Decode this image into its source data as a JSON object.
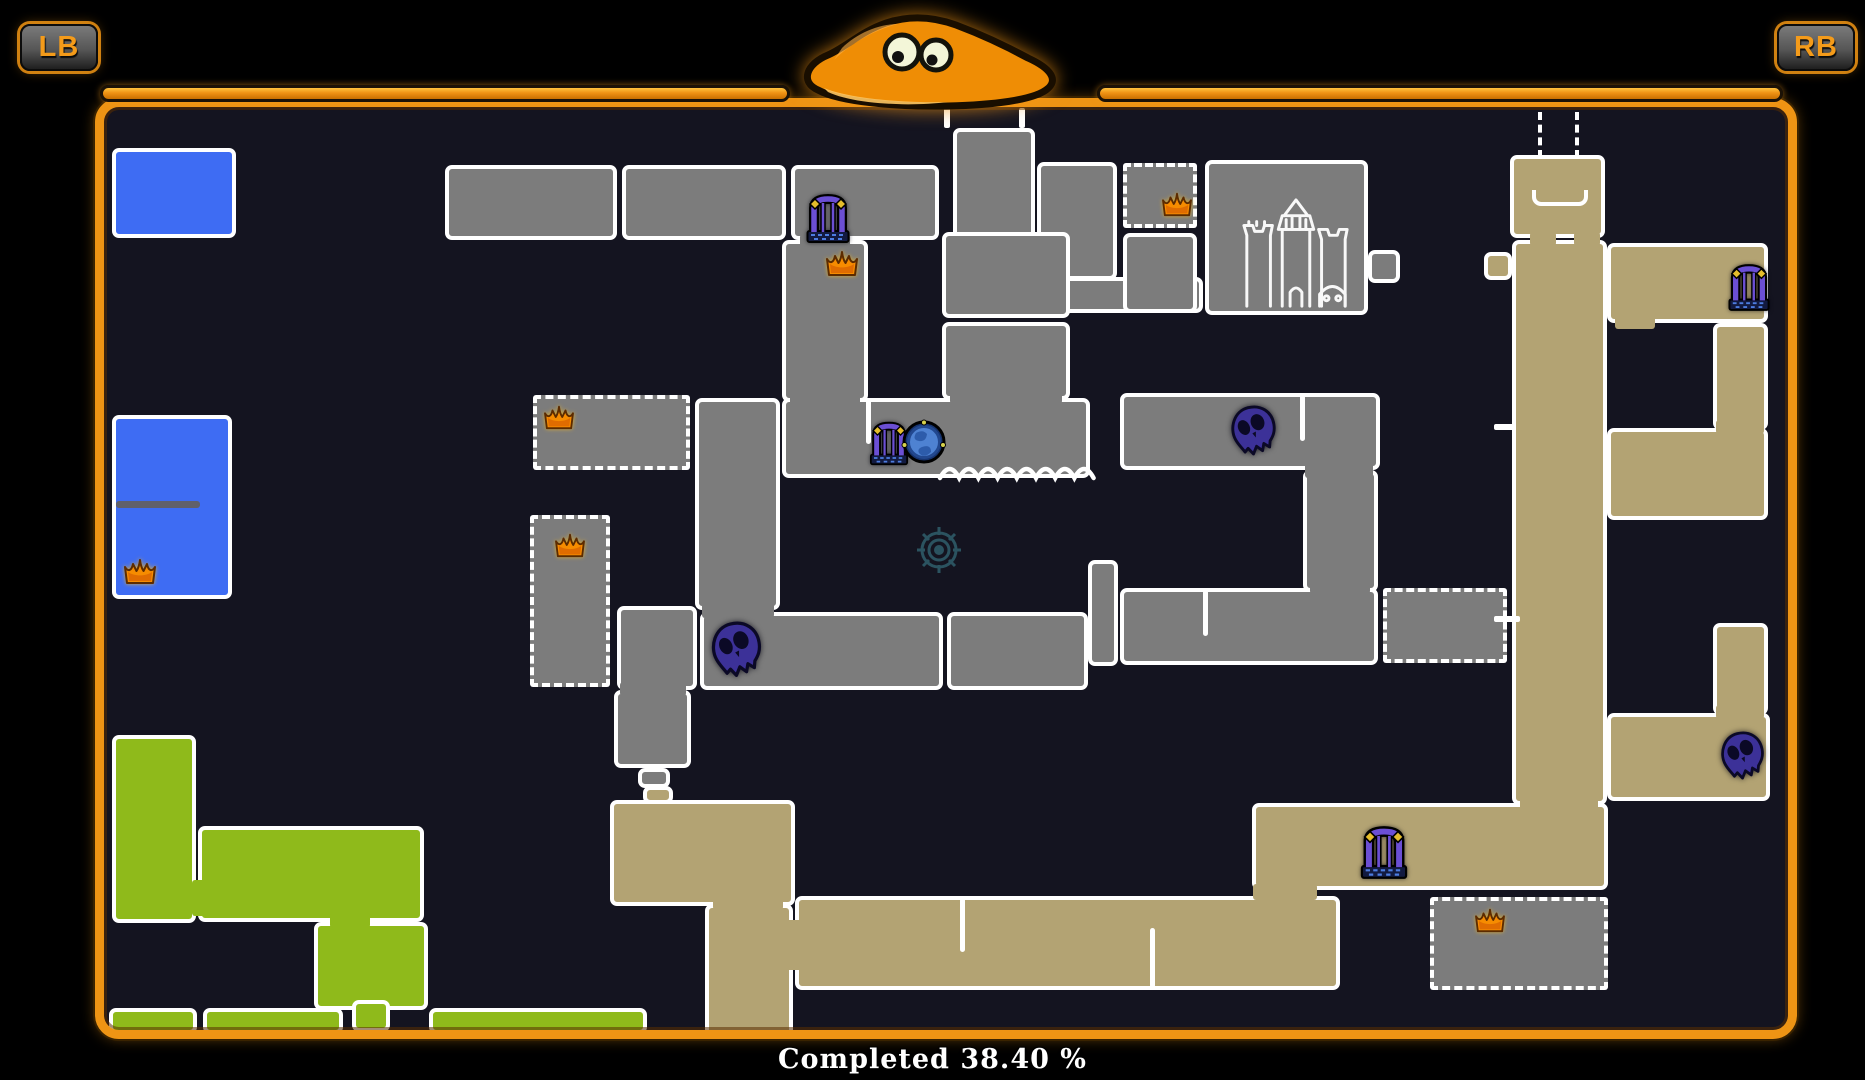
{
  "hud": {
    "left_bumper": "LB",
    "right_bumper": "RB",
    "completion_text": "Completed 38.40 %"
  },
  "colors": {
    "orange": "#ee9414",
    "mapbg": "#141420",
    "gray": "#7c7c7c",
    "tan": "#b3a373",
    "blue": "#3e6cf3",
    "green": "#8fba1b",
    "wall": "#ffffff",
    "crown": "#f68c00",
    "skull": "#3c3198",
    "gate": "#6b4fd4",
    "orb": "#4e82d2",
    "target": "#2e5a68"
  },
  "map": {
    "rooms": [
      {
        "x": 112,
        "y": 148,
        "w": 124,
        "h": 90,
        "c": "blue"
      },
      {
        "x": 112,
        "y": 415,
        "w": 120,
        "h": 184,
        "c": "blue"
      },
      {
        "x": 112,
        "y": 735,
        "w": 84,
        "h": 188,
        "c": "green"
      },
      {
        "x": 198,
        "y": 826,
        "w": 226,
        "h": 96,
        "c": "green"
      },
      {
        "x": 314,
        "y": 922,
        "w": 114,
        "h": 88,
        "c": "green"
      },
      {
        "x": 352,
        "y": 1000,
        "w": 38,
        "h": 32,
        "c": "green"
      },
      {
        "x": 109,
        "y": 1008,
        "w": 88,
        "h": 26,
        "c": "green"
      },
      {
        "x": 203,
        "y": 1008,
        "w": 140,
        "h": 26,
        "c": "green"
      },
      {
        "x": 429,
        "y": 1008,
        "w": 218,
        "h": 26,
        "c": "green"
      },
      {
        "x": 445,
        "y": 165,
        "w": 172,
        "h": 75,
        "c": "gray"
      },
      {
        "x": 622,
        "y": 165,
        "w": 164,
        "h": 75,
        "c": "gray"
      },
      {
        "x": 791,
        "y": 165,
        "w": 148,
        "h": 75,
        "c": "gray"
      },
      {
        "x": 953,
        "y": 128,
        "w": 82,
        "h": 112,
        "c": "gray"
      },
      {
        "x": 1037,
        "y": 162,
        "w": 80,
        "h": 118,
        "c": "gray"
      },
      {
        "x": 1037,
        "y": 277,
        "w": 166,
        "h": 36,
        "c": "gray"
      },
      {
        "x": 1123,
        "y": 163,
        "w": 74,
        "h": 65,
        "c": "gray",
        "b": "dashed"
      },
      {
        "x": 1123,
        "y": 233,
        "w": 74,
        "h": 80,
        "c": "gray"
      },
      {
        "x": 1205,
        "y": 160,
        "w": 163,
        "h": 155,
        "c": "gray"
      },
      {
        "x": 1368,
        "y": 250,
        "w": 32,
        "h": 33,
        "c": "gray"
      },
      {
        "x": 782,
        "y": 240,
        "w": 86,
        "h": 162,
        "c": "gray"
      },
      {
        "x": 942,
        "y": 232,
        "w": 128,
        "h": 86,
        "c": "gray"
      },
      {
        "x": 942,
        "y": 322,
        "w": 128,
        "h": 78,
        "c": "gray"
      },
      {
        "x": 782,
        "y": 398,
        "w": 308,
        "h": 80,
        "c": "gray"
      },
      {
        "x": 695,
        "y": 398,
        "w": 85,
        "h": 212,
        "c": "gray"
      },
      {
        "x": 533,
        "y": 395,
        "w": 157,
        "h": 75,
        "c": "gray",
        "b": "dashed"
      },
      {
        "x": 530,
        "y": 515,
        "w": 80,
        "h": 172,
        "c": "gray",
        "b": "dashed"
      },
      {
        "x": 617,
        "y": 606,
        "w": 80,
        "h": 84,
        "c": "gray"
      },
      {
        "x": 700,
        "y": 612,
        "w": 243,
        "h": 78,
        "c": "gray"
      },
      {
        "x": 947,
        "y": 612,
        "w": 141,
        "h": 78,
        "c": "gray"
      },
      {
        "x": 1088,
        "y": 560,
        "w": 30,
        "h": 106,
        "c": "gray"
      },
      {
        "x": 614,
        "y": 690,
        "w": 77,
        "h": 78,
        "c": "gray"
      },
      {
        "x": 638,
        "y": 768,
        "w": 32,
        "h": 20,
        "c": "gray"
      },
      {
        "x": 1120,
        "y": 393,
        "w": 260,
        "h": 77,
        "c": "gray"
      },
      {
        "x": 1303,
        "y": 470,
        "w": 75,
        "h": 122,
        "c": "gray"
      },
      {
        "x": 1120,
        "y": 588,
        "w": 258,
        "h": 77,
        "c": "gray"
      },
      {
        "x": 1383,
        "y": 588,
        "w": 124,
        "h": 75,
        "c": "gray",
        "b": "dashed"
      },
      {
        "x": 1430,
        "y": 897,
        "w": 178,
        "h": 93,
        "c": "gray",
        "b": "dashed"
      },
      {
        "x": 643,
        "y": 786,
        "w": 30,
        "h": 18,
        "c": "tan"
      },
      {
        "x": 610,
        "y": 800,
        "w": 185,
        "h": 106,
        "c": "tan"
      },
      {
        "x": 705,
        "y": 904,
        "w": 88,
        "h": 134,
        "c": "tan"
      },
      {
        "x": 795,
        "y": 896,
        "w": 545,
        "h": 94,
        "c": "tan"
      },
      {
        "x": 1252,
        "y": 803,
        "w": 356,
        "h": 87,
        "c": "tan"
      },
      {
        "x": 1510,
        "y": 155,
        "w": 95,
        "h": 83,
        "c": "tan"
      },
      {
        "x": 1512,
        "y": 240,
        "w": 95,
        "h": 565,
        "c": "tan"
      },
      {
        "x": 1484,
        "y": 252,
        "w": 28,
        "h": 28,
        "c": "tan"
      },
      {
        "x": 1607,
        "y": 243,
        "w": 161,
        "h": 80,
        "c": "tan"
      },
      {
        "x": 1713,
        "y": 323,
        "w": 55,
        "h": 107,
        "c": "tan"
      },
      {
        "x": 1607,
        "y": 428,
        "w": 161,
        "h": 92,
        "c": "tan"
      },
      {
        "x": 1713,
        "y": 623,
        "w": 55,
        "h": 92,
        "c": "tan"
      },
      {
        "x": 1607,
        "y": 713,
        "w": 163,
        "h": 88,
        "c": "tan"
      },
      {
        "x": 790,
        "y": 392,
        "w": 70,
        "h": 14,
        "c": "gray",
        "b": "none"
      },
      {
        "x": 950,
        "y": 390,
        "w": 112,
        "h": 14,
        "c": "gray",
        "b": "none"
      },
      {
        "x": 800,
        "y": 234,
        "w": 50,
        "h": 14,
        "c": "gray",
        "b": "none"
      },
      {
        "x": 702,
        "y": 602,
        "w": 72,
        "h": 16,
        "c": "gray",
        "b": "none"
      },
      {
        "x": 620,
        "y": 682,
        "w": 66,
        "h": 14,
        "c": "gray",
        "b": "none"
      },
      {
        "x": 1305,
        "y": 462,
        "w": 68,
        "h": 16,
        "c": "gray",
        "b": "none"
      },
      {
        "x": 1310,
        "y": 580,
        "w": 60,
        "h": 14,
        "c": "gray",
        "b": "none"
      },
      {
        "x": 713,
        "y": 898,
        "w": 70,
        "h": 12,
        "c": "tan",
        "b": "none"
      },
      {
        "x": 780,
        "y": 920,
        "w": 24,
        "h": 50,
        "c": "tan",
        "b": "none"
      },
      {
        "x": 1520,
        "y": 798,
        "w": 78,
        "h": 12,
        "c": "tan",
        "b": "none"
      },
      {
        "x": 1253,
        "y": 884,
        "w": 64,
        "h": 16,
        "c": "tan",
        "b": "none"
      },
      {
        "x": 1615,
        "y": 315,
        "w": 40,
        "h": 14,
        "c": "tan",
        "b": "none"
      },
      {
        "x": 1716,
        "y": 420,
        "w": 48,
        "h": 14,
        "c": "tan",
        "b": "none"
      },
      {
        "x": 1716,
        "y": 705,
        "w": 48,
        "h": 14,
        "c": "tan",
        "b": "none"
      },
      {
        "x": 1530,
        "y": 232,
        "w": 26,
        "h": 14,
        "c": "tan",
        "b": "none"
      },
      {
        "x": 1574,
        "y": 232,
        "w": 26,
        "h": 14,
        "c": "tan",
        "b": "none"
      },
      {
        "x": 192,
        "y": 880,
        "w": 16,
        "h": 36,
        "c": "green",
        "b": "none"
      },
      {
        "x": 330,
        "y": 912,
        "w": 40,
        "h": 16,
        "c": "green",
        "b": "none"
      },
      {
        "x": 116,
        "y": 501,
        "w": 84,
        "h": 7,
        "c": "divider",
        "b": "none"
      }
    ],
    "icons": [
      {
        "t": "crown",
        "x": 122,
        "y": 556,
        "w": 36,
        "h": 30
      },
      {
        "t": "crown",
        "x": 824,
        "y": 248,
        "w": 36,
        "h": 30
      },
      {
        "t": "crown",
        "x": 541,
        "y": 403,
        "w": 36,
        "h": 28
      },
      {
        "t": "crown",
        "x": 553,
        "y": 531,
        "w": 34,
        "h": 28
      },
      {
        "t": "crown",
        "x": 1160,
        "y": 190,
        "w": 34,
        "h": 28
      },
      {
        "t": "crown",
        "x": 1473,
        "y": 906,
        "w": 34,
        "h": 28
      },
      {
        "t": "skull",
        "x": 708,
        "y": 620,
        "w": 58,
        "h": 62
      },
      {
        "t": "skull",
        "x": 1228,
        "y": 404,
        "w": 52,
        "h": 56
      },
      {
        "t": "skull",
        "x": 1718,
        "y": 730,
        "w": 50,
        "h": 54
      },
      {
        "t": "gate",
        "x": 806,
        "y": 192,
        "w": 44,
        "h": 52
      },
      {
        "t": "gate",
        "x": 869,
        "y": 420,
        "w": 40,
        "h": 46
      },
      {
        "t": "gate",
        "x": 1360,
        "y": 824,
        "w": 48,
        "h": 56
      },
      {
        "t": "gate",
        "x": 1728,
        "y": 261,
        "w": 42,
        "h": 52
      },
      {
        "t": "orb",
        "x": 901,
        "y": 418,
        "w": 46,
        "h": 48
      },
      {
        "t": "castle",
        "x": 1236,
        "y": 196,
        "w": 120,
        "h": 118
      },
      {
        "t": "target",
        "x": 914,
        "y": 524,
        "w": 50,
        "h": 52
      },
      {
        "t": "wall-slit",
        "x": 960,
        "y": 898,
        "w": 5,
        "h": 54
      },
      {
        "t": "wall-slit",
        "x": 1150,
        "y": 928,
        "w": 5,
        "h": 60
      },
      {
        "t": "wall-slit",
        "x": 1203,
        "y": 590,
        "w": 5,
        "h": 46
      },
      {
        "t": "wall-slit",
        "x": 1300,
        "y": 395,
        "w": 5,
        "h": 46
      },
      {
        "t": "wall-slit",
        "x": 866,
        "y": 398,
        "w": 5,
        "h": 46
      },
      {
        "t": "wall-tick",
        "x": 944,
        "y": 102,
        "w": 6,
        "h": 26
      },
      {
        "t": "wall-tick",
        "x": 1019,
        "y": 108,
        "w": 6,
        "h": 20
      },
      {
        "t": "wall-tick",
        "x": 1494,
        "y": 424,
        "w": 22,
        "h": 6
      },
      {
        "t": "wall-tick",
        "x": 1494,
        "y": 616,
        "w": 26,
        "h": 6
      },
      {
        "t": "dash-line",
        "x": 1538,
        "y": 112,
        "w": 4,
        "h": 46
      },
      {
        "t": "dash-line",
        "x": 1575,
        "y": 112,
        "w": 4,
        "h": 46
      },
      {
        "t": "bracket",
        "x": 1532,
        "y": 190,
        "w": 56,
        "h": 16
      },
      {
        "t": "scallop",
        "x": 938,
        "y": 464,
        "w": 156,
        "h": 24
      }
    ]
  }
}
